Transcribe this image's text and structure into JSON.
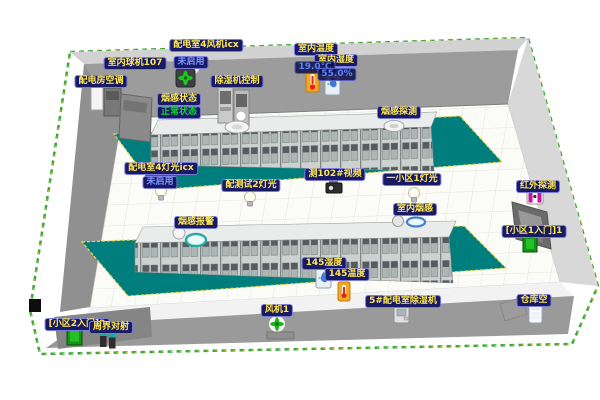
{
  "view": {
    "description_labels_language": "zh-CN",
    "room_type_hint": "3D power distribution room monitoring view"
  },
  "colors": {
    "mat_teal": "#007d7d",
    "label_bg": "#181a66",
    "label_text_yellow": "#ffe84d",
    "status_ok_green": "#16d43c",
    "disabled_blue": "#7e97ff",
    "reading_blue": "#5a83ff",
    "wall_gray": "#9c9c9c",
    "right_wall_gray": "#d8d8d8",
    "perimeter_border_green": "#3aa63a",
    "mat_border_yellow": "#ead84e",
    "fan_green": "#1ec91e",
    "door_green": "#149414",
    "infrared_magenta": "#c0189c",
    "thermometer_orange": "#f5a623",
    "alarm_red": "#e02020",
    "humidity_blue": "#3b7fd4"
  },
  "readings": {
    "indoor_temperature": "19.0℃",
    "indoor_humidity": "55.0%"
  },
  "labels": {
    "dist_fan": {
      "text": "配电室4风机icx"
    },
    "indoor_dome_camera": {
      "text": "室内球机107"
    },
    "fan_disabled": {
      "text": "未启用"
    },
    "dehumidifier_control": {
      "text": "除湿机控制"
    },
    "dist_room_ac": {
      "text": "配电房空调"
    },
    "indoor_temp": {
      "text": "室内温度"
    },
    "indoor_humidity": {
      "text": "室内湿度"
    },
    "smoke_status": {
      "text": "烟感状态"
    },
    "smoke_status_value": {
      "text": "正常状态"
    },
    "smoke_detect": {
      "text": "烟感探测"
    },
    "dist_light4": {
      "text": "配电室4灯光icx"
    },
    "light_disabled": {
      "text": "未启用"
    },
    "test_light2": {
      "text": "配测试2灯光"
    },
    "video_102": {
      "text": "测102#视频"
    },
    "area1_light1": {
      "text": "一小区1灯光"
    },
    "indoor_smoke": {
      "text": "室内烟感"
    },
    "smoke_alarm": {
      "text": "烟感报警"
    },
    "humidity_145": {
      "text": "145湿度"
    },
    "temp_145": {
      "text": "145温度"
    },
    "dehumidifier_5": {
      "text": "5#配电室除湿机"
    },
    "fan_1": {
      "text": "风机1"
    },
    "infrared": {
      "text": "红外探测"
    },
    "gate_area1": {
      "text": "[小区1入门]1"
    },
    "warehouse_ac": {
      "text": "仓库空"
    },
    "gate_area2": {
      "text": "[小区2入门]2"
    },
    "perimeter_beam": {
      "text": "周界对射"
    }
  },
  "icons": [
    "dome-camera-icon",
    "ceiling-fan-icon",
    "ac-unit-icon",
    "dehumidifier-cabinet-icon",
    "thermometer-icon",
    "humidity-icon",
    "smoke-sensor-icon",
    "smoke-ring-sensor-icon",
    "light-bulb-icon",
    "cctv-camera-icon",
    "portable-dehumidifier-icon",
    "floor-fan-icon",
    "infrared-detector-icon",
    "entry-door-icon",
    "perimeter-beam-icon",
    "warehouse-device-icon"
  ]
}
